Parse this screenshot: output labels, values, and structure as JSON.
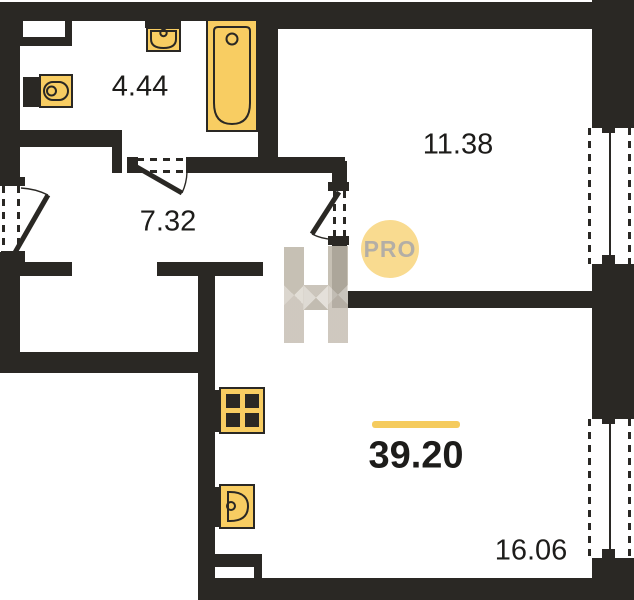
{
  "title": "Apartment floor plan",
  "colors": {
    "wall": "#2a2824",
    "fixture": "#f8cd62",
    "accent_line": "#f5cb5d",
    "watermark_circle": "#f9db90",
    "watermark_text": "#b3aea6",
    "watermark_h": "#cec8be",
    "label_text": "#1d1c1a"
  },
  "rooms": [
    {
      "name": "bathroom",
      "area": "4.44"
    },
    {
      "name": "hallway",
      "area": "7.32"
    },
    {
      "name": "bedroom",
      "area": "11.38"
    },
    {
      "name": "living-room",
      "area": "16.06"
    }
  ],
  "total_area": "39.20",
  "watermark": {
    "label": "PRO"
  },
  "fixtures": [
    "toilet-icon",
    "wall-sink-icon",
    "bathtub-icon",
    "stove-icon",
    "kitchen-sink-icon"
  ],
  "symbols": [
    "entrance-door-swing",
    "bathroom-door-swing",
    "bedroom-door-swing",
    "bedroom-window",
    "living-room-window"
  ]
}
